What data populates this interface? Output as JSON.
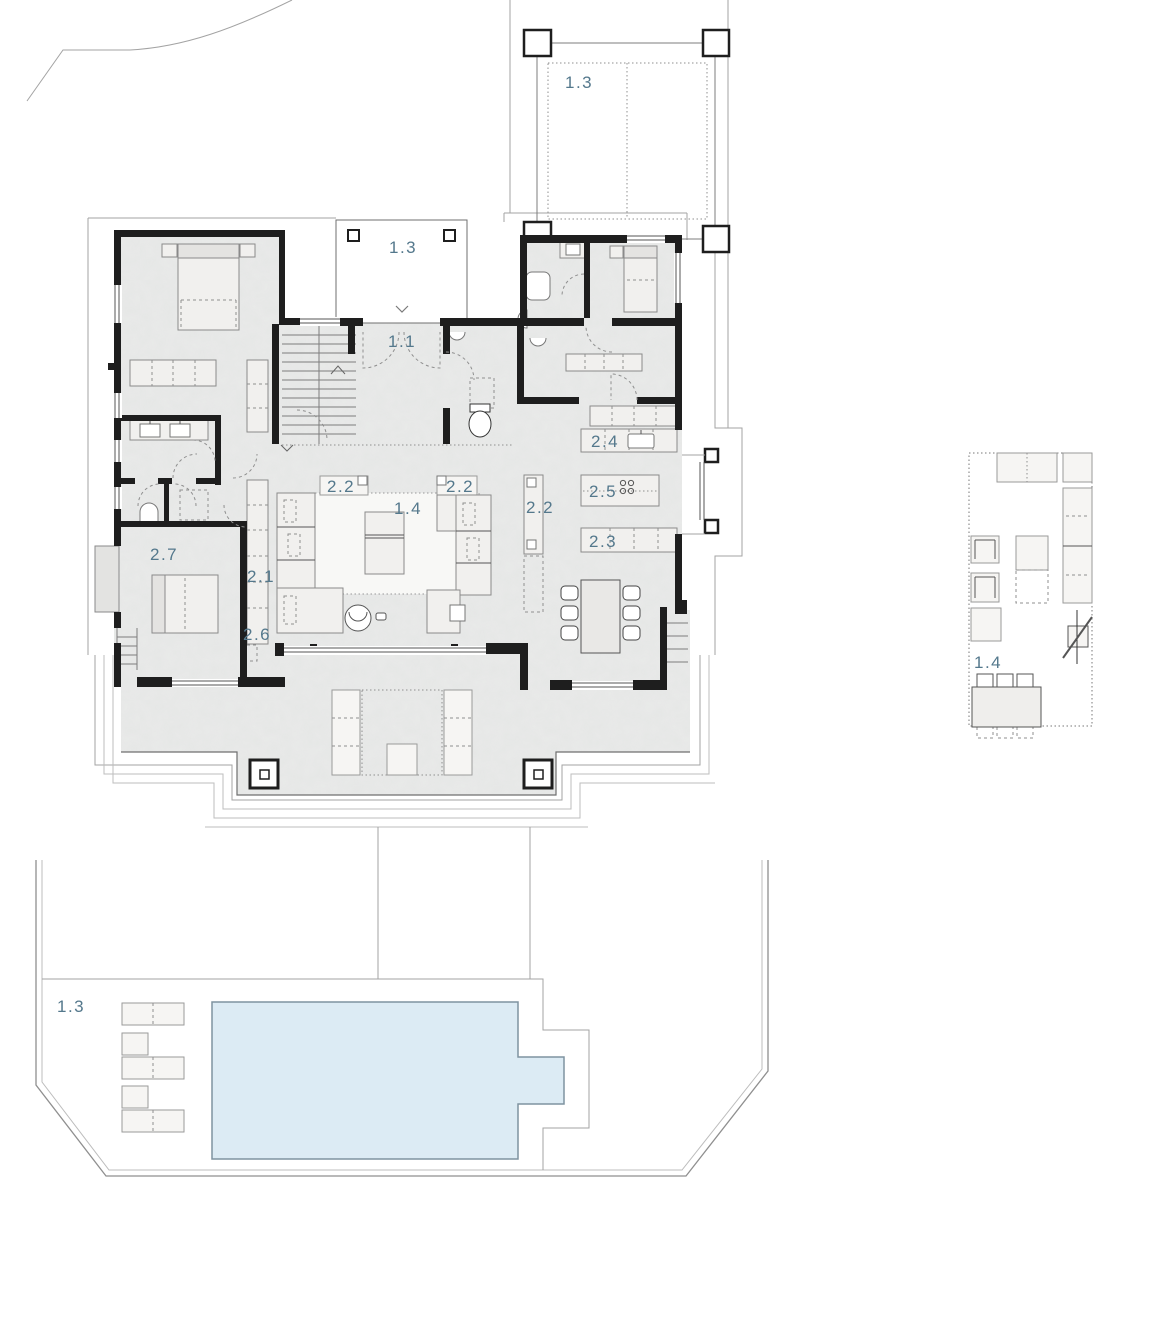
{
  "title": "Villa ground floor plan with carport, pool terrace and furniture detail",
  "colors": {
    "label_text": "#54788c",
    "wall": "#1e1e1e",
    "floor": "#eaebea",
    "pool_water": "#dcebf4",
    "site_line": "#a3a3a3",
    "furniture_fill": "#f1f0ee"
  },
  "labels": {
    "carport": "1.3",
    "entry_porch": "1.3",
    "entry_hall": "1.1",
    "kitchen_counter": "2.4",
    "kitchen_island": "2.5",
    "kitchen_counter_low": "2.3",
    "kitchen_tall_unit": "2.2",
    "sofa_left": "2.2",
    "sofa_right": "2.2",
    "living_room": "1.4",
    "corridor_wardrobe": "2.1",
    "corridor_cabinet": "2.6",
    "bedroom_left": "2.7",
    "furniture_detail": "1.4",
    "pool_area": "1.3"
  }
}
